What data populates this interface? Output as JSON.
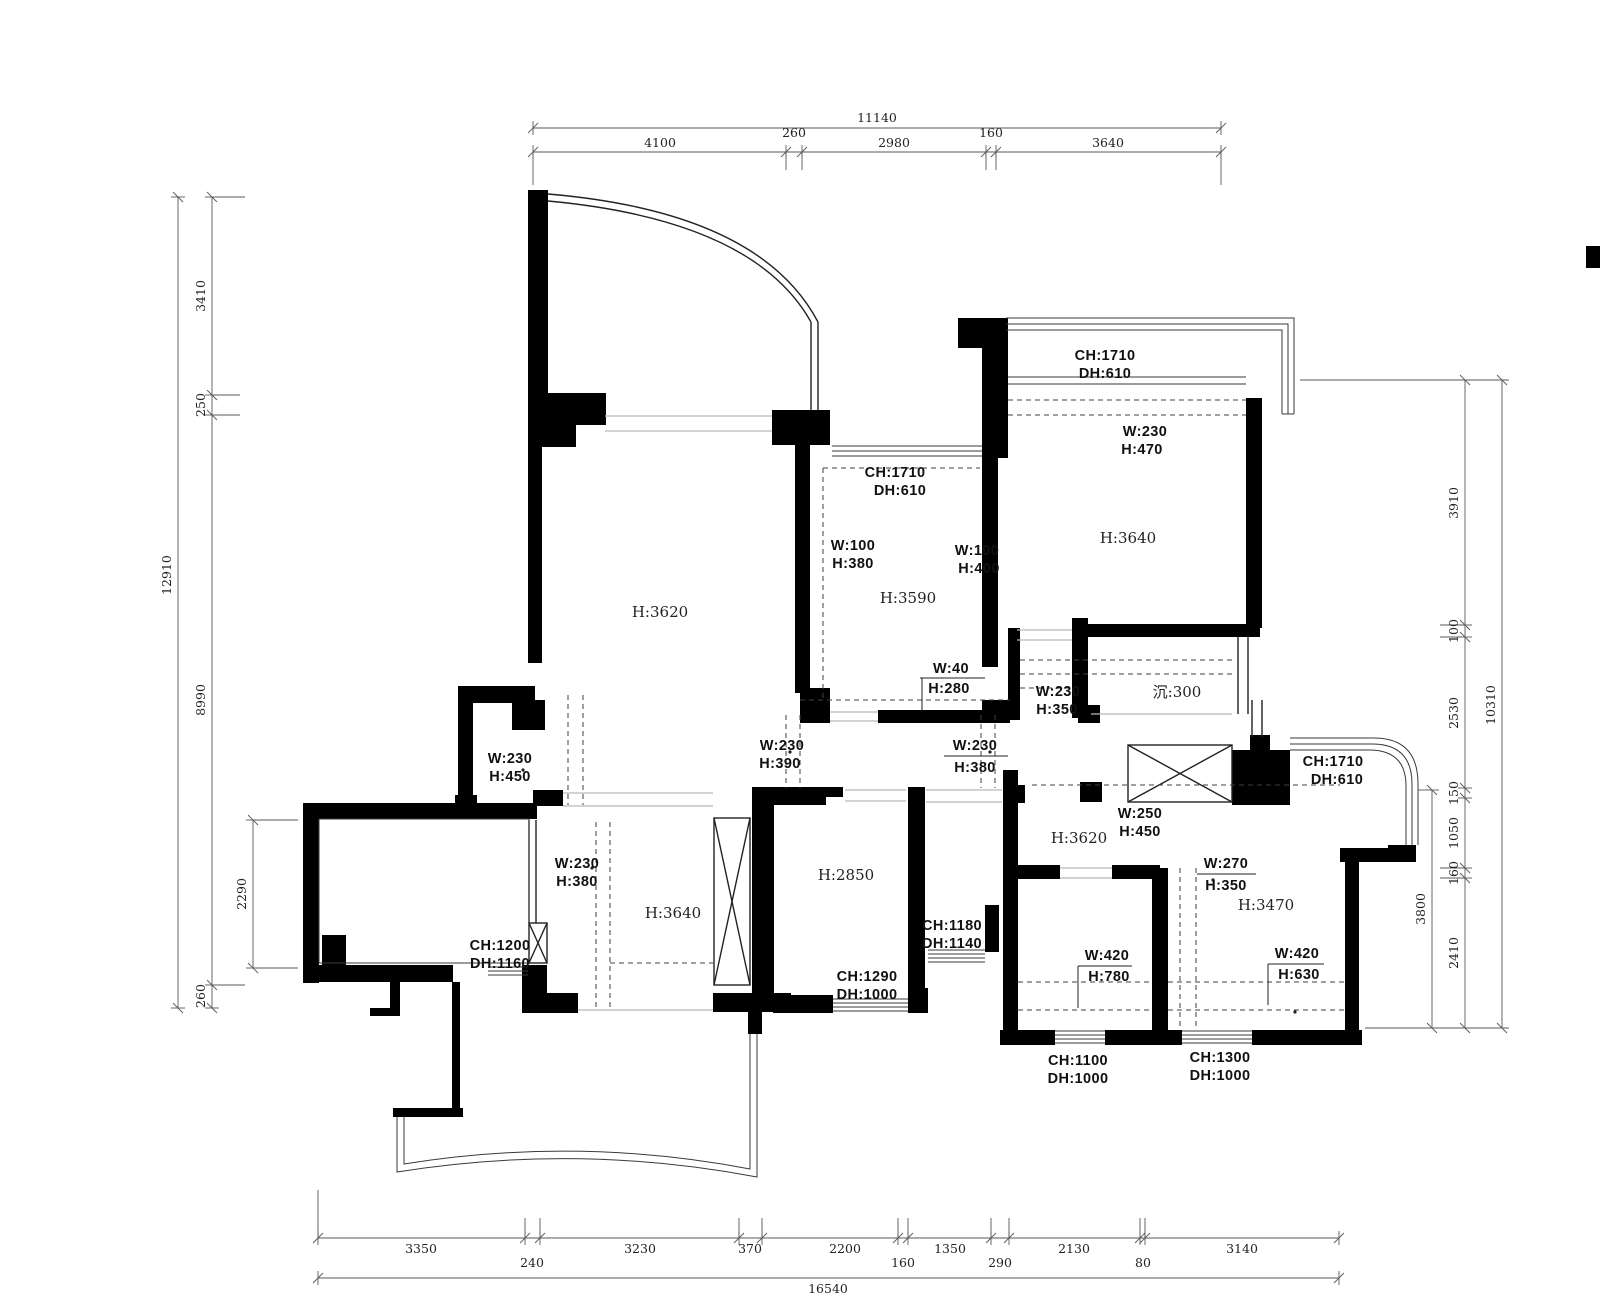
{
  "drawing": {
    "title": "apartment-floor-plan",
    "rooms": [
      {
        "label": "H:3620"
      },
      {
        "label": "H:3590"
      },
      {
        "label": "H:3640"
      },
      {
        "label": "沉:300"
      },
      {
        "label": "H:3640"
      },
      {
        "label": "H:2850"
      },
      {
        "label": "H:3620"
      },
      {
        "label": "H:3470"
      }
    ],
    "annotations": [
      {
        "line1": "CH:1710",
        "line2": "DH:610"
      },
      {
        "line1": "W:230",
        "line2": "H:470"
      },
      {
        "line1": "CH:1710",
        "line2": "DH:610"
      },
      {
        "line1": "W:100",
        "line2": "H:380"
      },
      {
        "line1": "W:100",
        "line2": "H:400"
      },
      {
        "line1": "W:40",
        "line2": "H:280"
      },
      {
        "line1": "W:230",
        "line2": "H:350"
      },
      {
        "line1": "W:230",
        "line2": "H:390"
      },
      {
        "line1": "W:230",
        "line2": "H:380"
      },
      {
        "line1": "W:230",
        "line2": "H:450"
      },
      {
        "line1": "W:230",
        "line2": "H:380"
      },
      {
        "line1": "CH:1200",
        "line2": "DH:1160"
      },
      {
        "line1": "CH:1290",
        "line2": "DH:1000"
      },
      {
        "line1": "CH:1180",
        "line2": "DH:1140"
      },
      {
        "line1": "W:250",
        "line2": "H:450"
      },
      {
        "line1": "W:270",
        "line2": "H:350"
      },
      {
        "line1": "W:420",
        "line2": "H:780"
      },
      {
        "line1": "W:420",
        "line2": "H:630"
      },
      {
        "line1": "CH:1100",
        "line2": "DH:1000"
      },
      {
        "line1": "CH:1300",
        "line2": "DH:1000"
      },
      {
        "line1": "CH:1710",
        "line2": "DH:610"
      }
    ],
    "dimensions": {
      "top": {
        "total": "11140",
        "segments": [
          "4100",
          "260",
          "2980",
          "160",
          "3640"
        ]
      },
      "left": {
        "total": "12910",
        "segments": [
          "3410",
          "250",
          "8990",
          "260"
        ],
        "aux": "2290"
      },
      "right": {
        "total": "10310",
        "segments": [
          "3910",
          "100",
          "2530",
          "150",
          "1050",
          "160",
          "2410"
        ],
        "aux": "3800"
      },
      "bottom": {
        "total": "16540",
        "segments": [
          "3350",
          "240",
          "3230",
          "370",
          "2200",
          "160",
          "1350",
          "290",
          "2130",
          "80",
          "3140"
        ]
      }
    },
    "colors": {
      "wall": "#000000",
      "dim_line": "#5a5a5a",
      "dashed": "#3f3f3f",
      "opening": "#b9b9b9",
      "text": "#111111"
    }
  }
}
